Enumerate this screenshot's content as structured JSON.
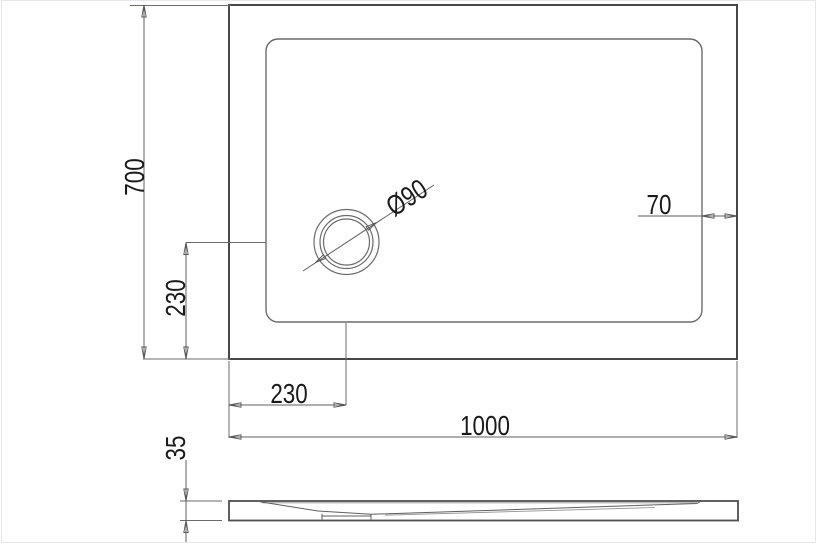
{
  "labels": {
    "height": "700",
    "drain_offset_vertical": "230",
    "drain_offset_horizontal": "230",
    "width": "1000",
    "rim_width": "70",
    "drain_diameter": "Ø90",
    "thickness": "35"
  },
  "colors": {
    "outline": "#474747",
    "basin_outline": "#6b6b6b",
    "dimension_line": "#5f5f5f",
    "text": "#1a1a1a",
    "frame_border": "#e5e7ea",
    "background": "#ffffff"
  }
}
